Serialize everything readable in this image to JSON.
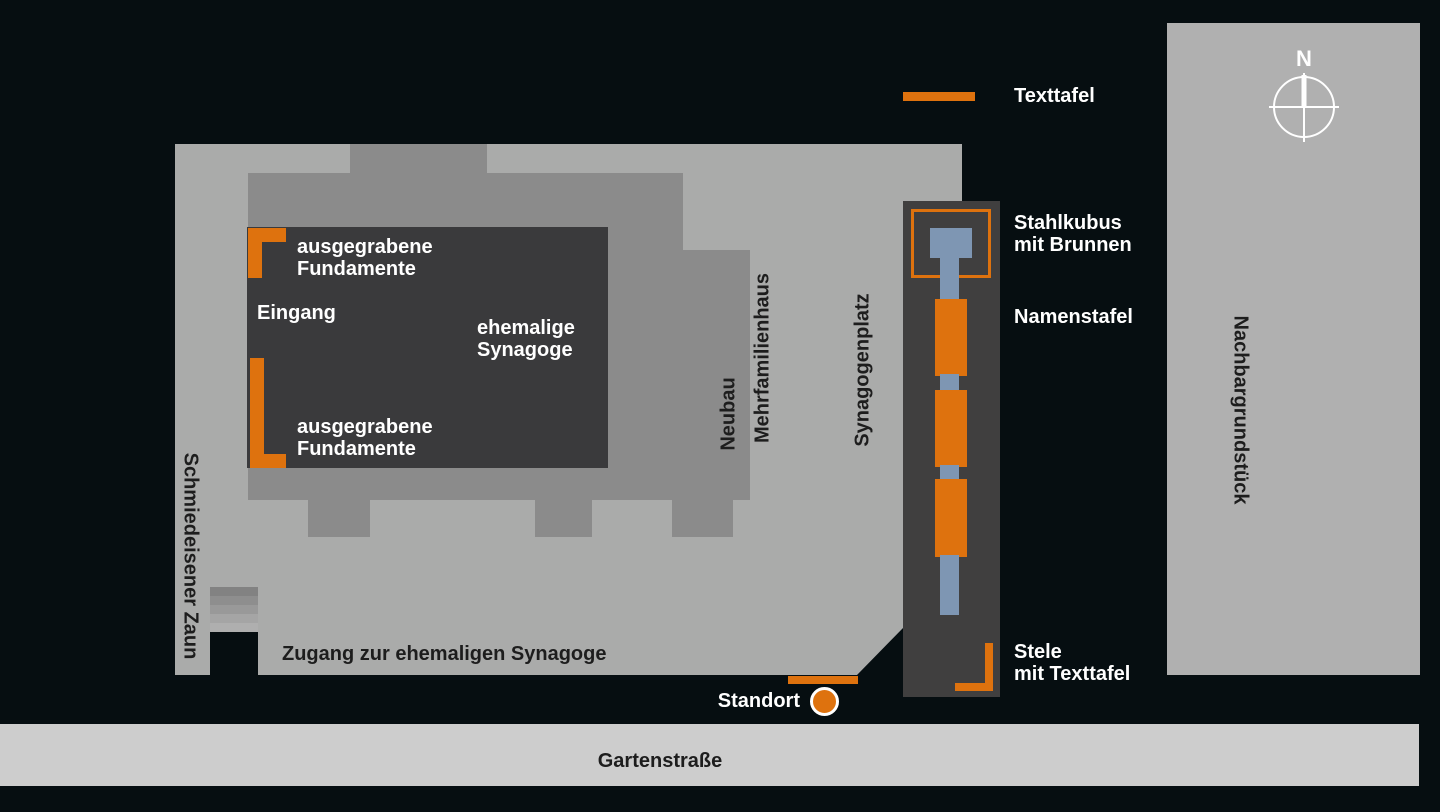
{
  "title": "Lageplan Synagogenplatz (site plan of former synagogue memorial)",
  "legend": {
    "texttafel": "Texttafel"
  },
  "compass": {
    "north": "N"
  },
  "map": {
    "site_labels": {
      "fundamente_upper": "ausgegrabene\nFundamente",
      "eingang": "Eingang",
      "ehemalige_synagoge": "ehemalige\nSynagoge",
      "fundamente_lower": "ausgegrabene\nFundamente",
      "zugang": "Zugang zur ehemaligen Synagoge",
      "schmiedeisener_zaun": "Schmiedeisener Zaun",
      "neubau": "Neubau",
      "mehrfamilienhaus": "Mehrfamilienhaus",
      "synagogenplatz": "Synagogenplatz",
      "nachbargrundstueck": "Nachbargrundstück",
      "standort": "Standort",
      "gartenstrasse": "Gartenstraße"
    },
    "memorial_labels": {
      "stahlkubus": "Stahlkubus\nmit Brunnen",
      "namenstafel": "Namenstafel",
      "stele": "Stele\nmit Texttafel"
    }
  },
  "colors": {
    "background": "#060e11",
    "plaza_gray": "#aaabaa",
    "building_outline_gray": "#8b8b8b",
    "dark_area": "#3a3a3c",
    "memorial_strip": "#403f3f",
    "neighbor_lot_gray": "#b0b0b0",
    "street_gray": "#cdcdcd",
    "accent_orange": "#de720e",
    "fountain_blue": "#7e96b3",
    "label_white": "#ffffff",
    "label_dark": "#1d1d1d"
  }
}
